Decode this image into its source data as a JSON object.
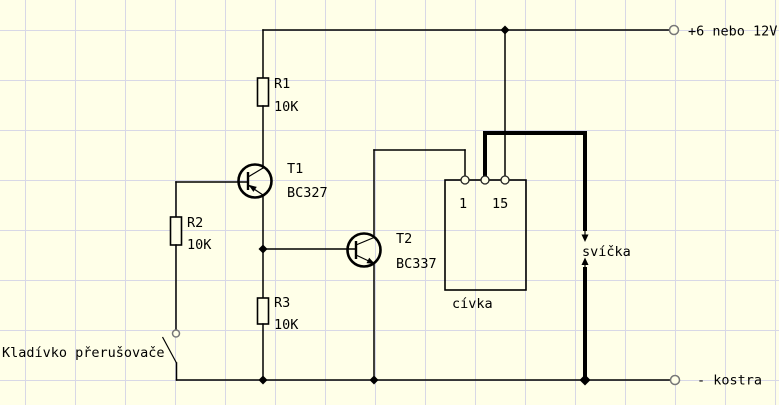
{
  "schematic": {
    "colors": {
      "background": "#ffffe8",
      "grid": "#d8d8e6",
      "wire": "#000000"
    },
    "rails": {
      "positive": "+6 nebo 12V",
      "negative": "- kostra"
    },
    "components": {
      "r1": {
        "name": "R1",
        "value": "10K"
      },
      "r2": {
        "name": "R2",
        "value": "10K"
      },
      "r3": {
        "name": "R3",
        "value": "10K"
      },
      "t1": {
        "name": "T1",
        "part": "BC327"
      },
      "t2": {
        "name": "T2",
        "part": "BC337"
      },
      "coil": {
        "label": "cívka",
        "pin_left": "1",
        "pin_right": "15"
      },
      "spark_plug": {
        "label": "svíčka"
      },
      "breaker": {
        "label": "Kladívko přerušovače"
      }
    }
  }
}
